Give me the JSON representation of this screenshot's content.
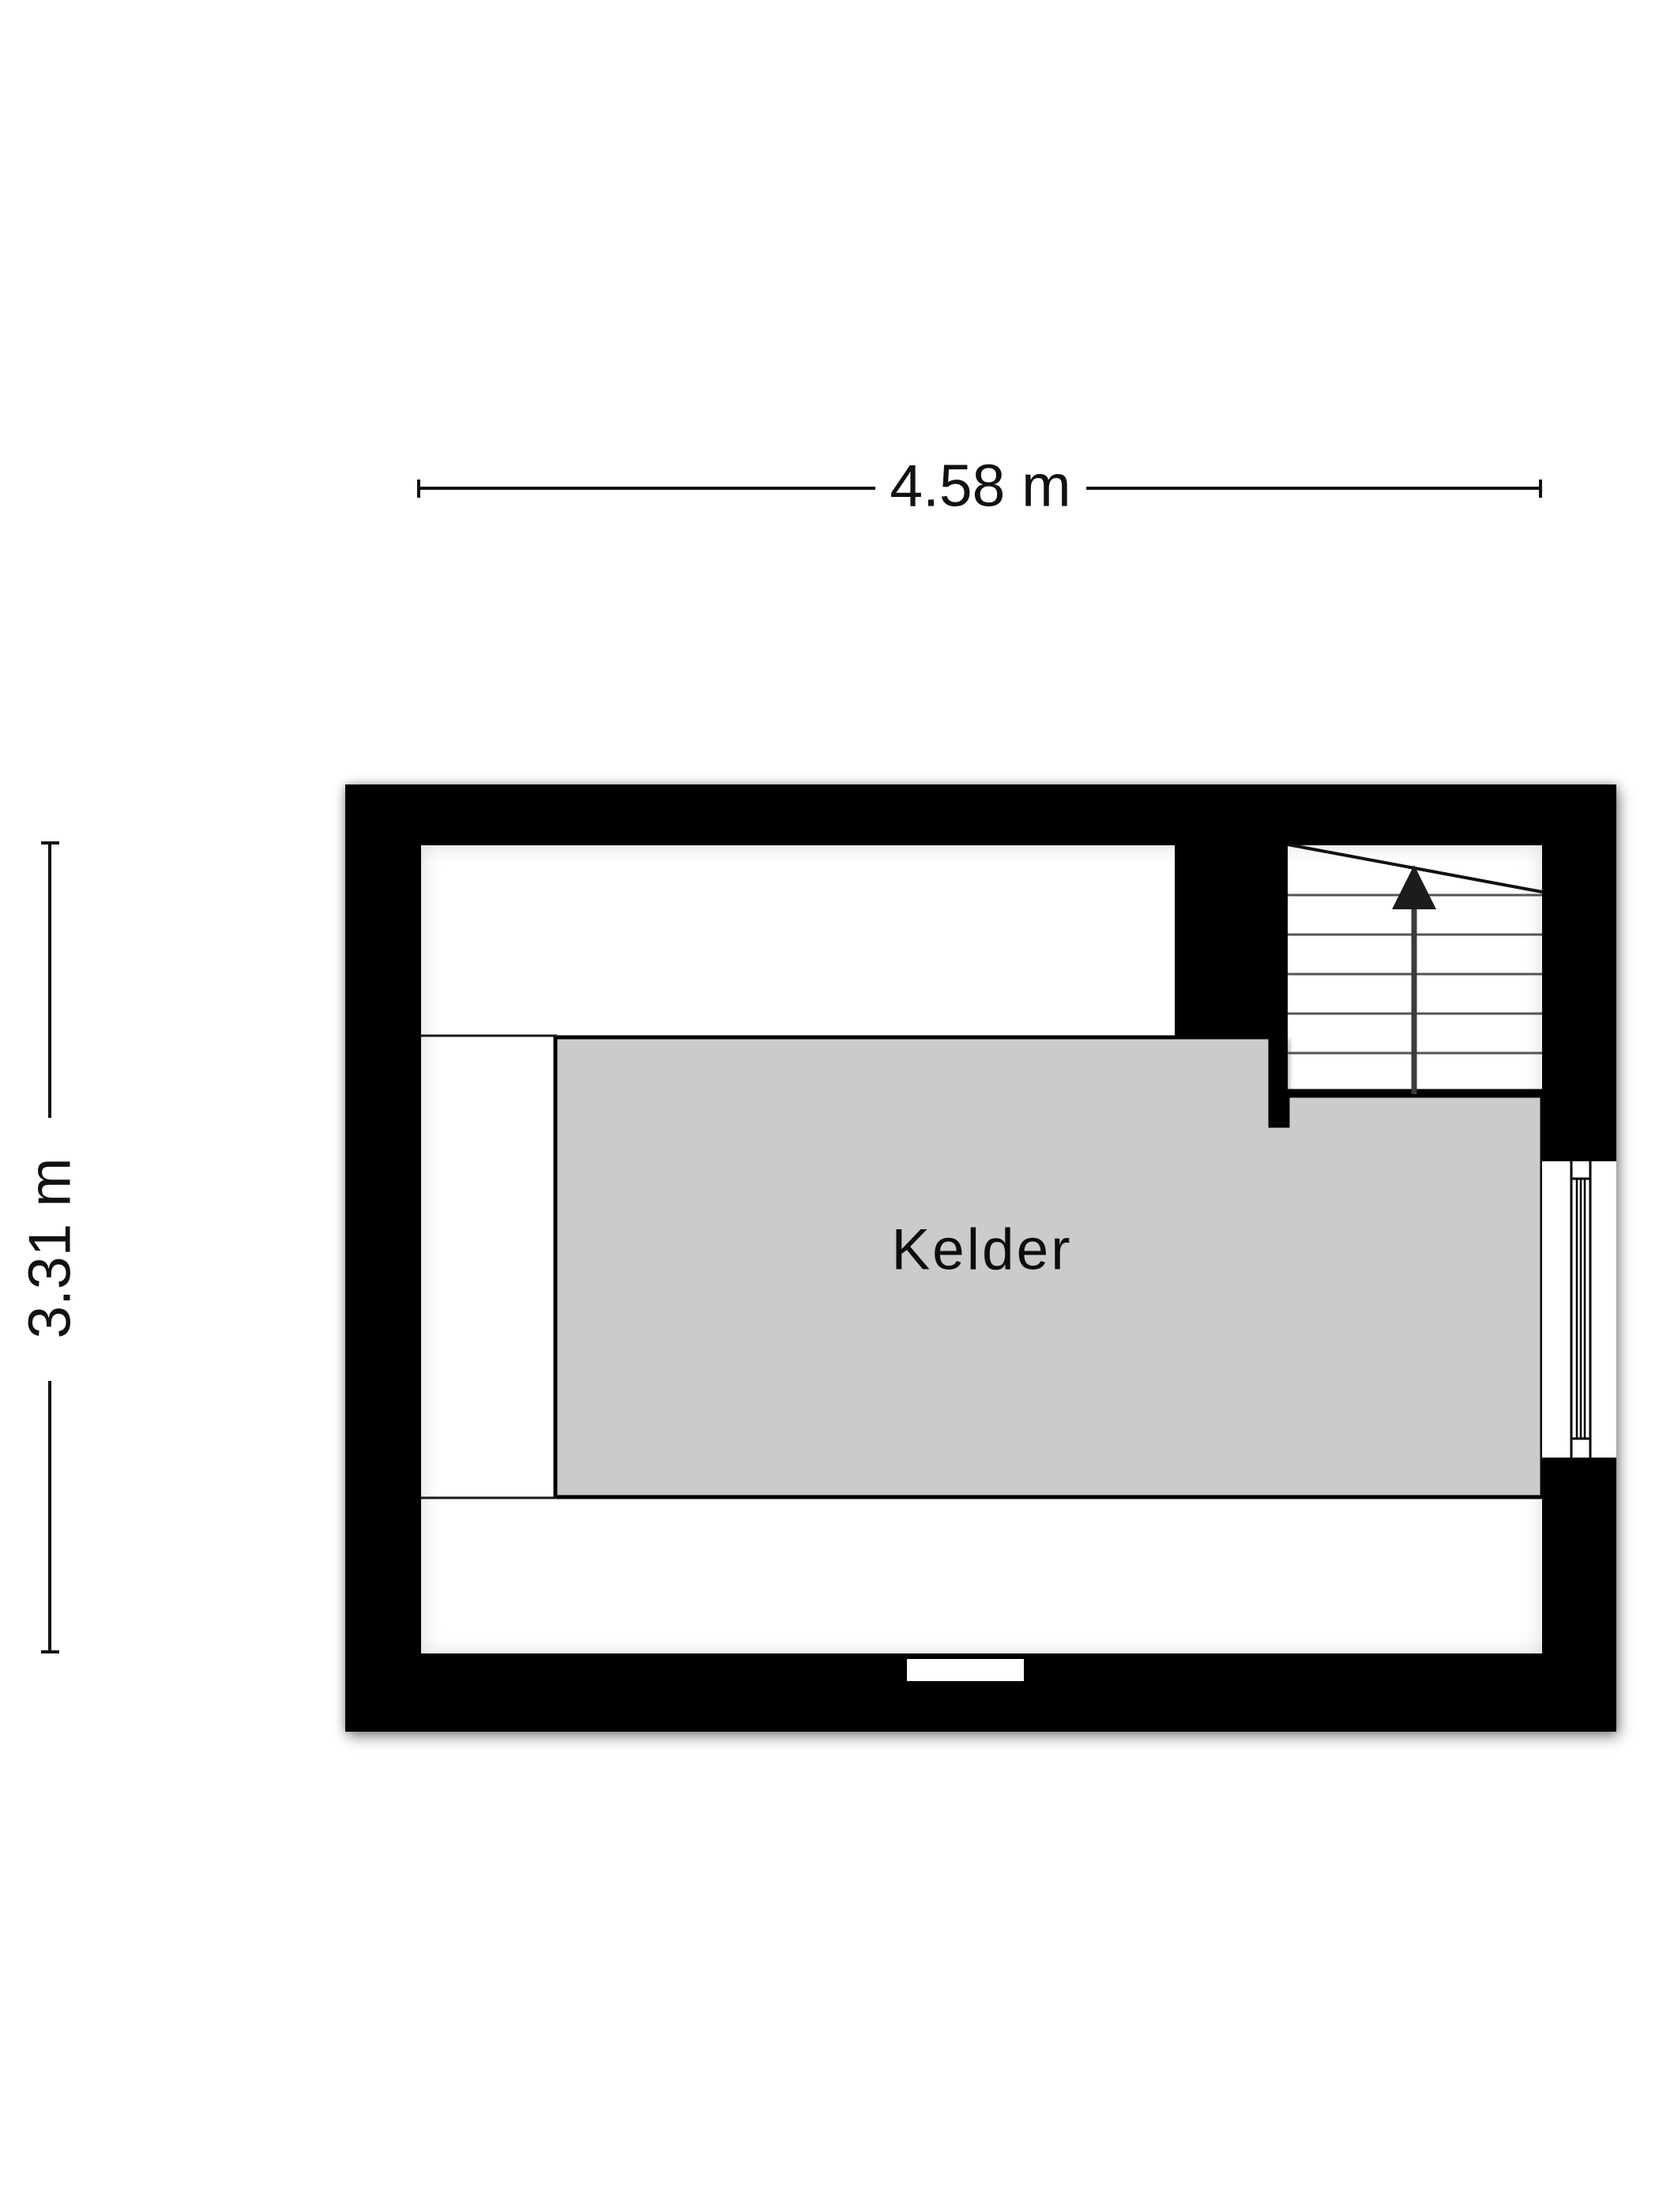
{
  "dimensions": {
    "width": {
      "label": "4.58 m",
      "value": 4.58,
      "unit": "m"
    },
    "height": {
      "label": "3.31 m",
      "value": 3.31,
      "unit": "m"
    }
  },
  "floorplan": {
    "room": {
      "label": "Kelder",
      "fill_color": "#cbcbcb"
    },
    "wall_color": "#000000",
    "floor_color": "#ffffff",
    "stairs": {
      "direction_icon": "arrow-up",
      "tread_count": 5
    },
    "features": [
      "stairs",
      "window",
      "wall-recess"
    ]
  }
}
